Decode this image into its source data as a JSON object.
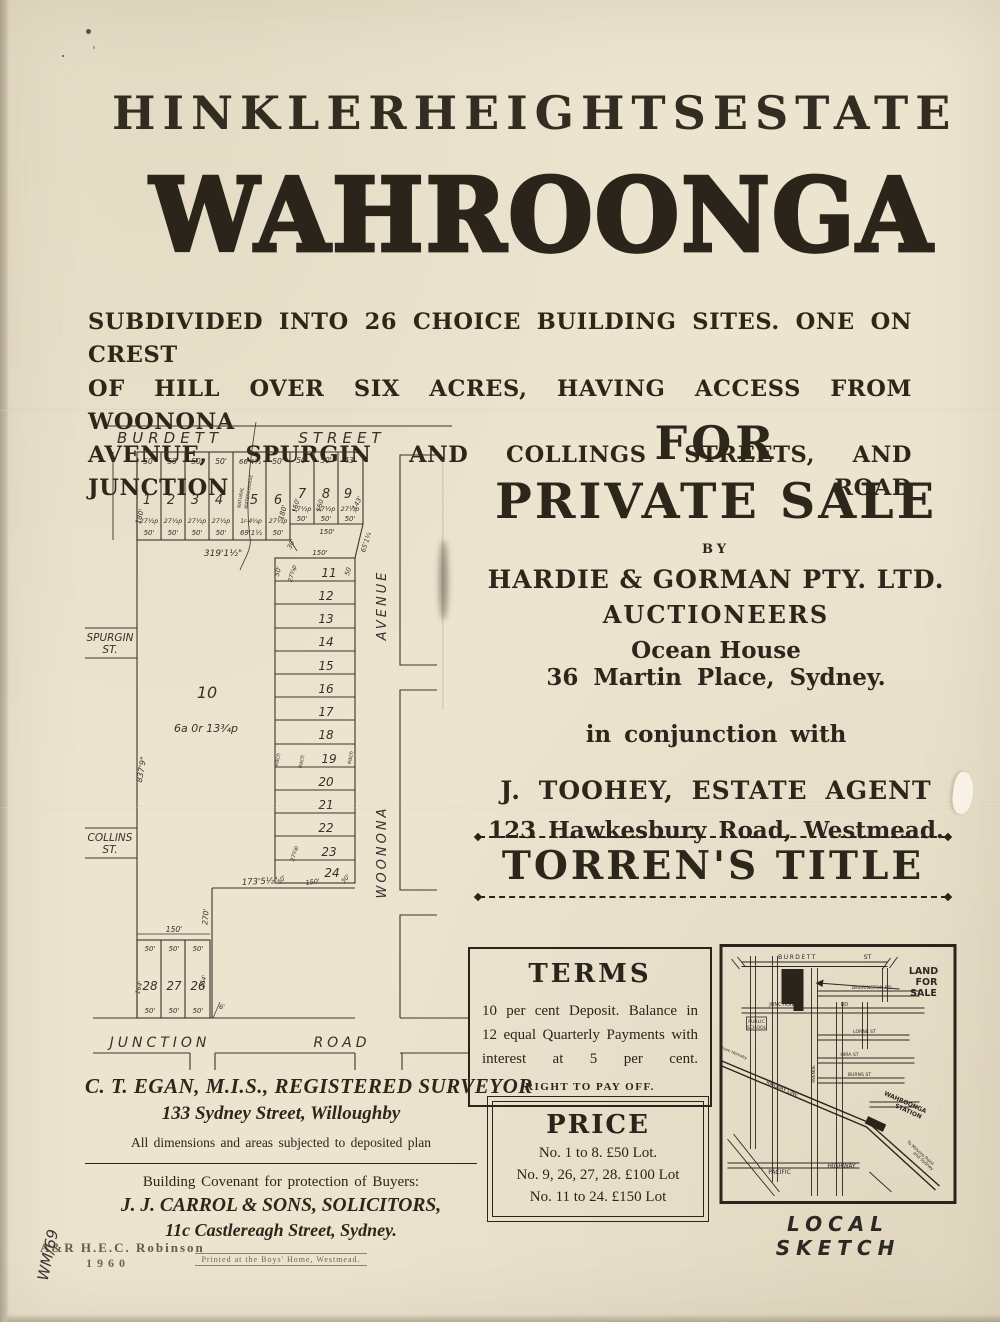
{
  "poster": {
    "kicker_words": [
      "HINKLER",
      "HEIGHTS",
      "ESTATE"
    ],
    "main_title": "WAHROONGA",
    "subtitle_lines": [
      "SUBDIVIDED INTO 26 CHOICE BUILDING SITES.  ONE ON CREST",
      "OF HILL OVER SIX ACRES, HAVING ACCESS FROM WOONONA",
      "AVENUE, SPURGIN AND COLLINGS STREETS, AND JUNCTION ROAD"
    ]
  },
  "sale": {
    "for": "FOR",
    "private_sale": "PRIVATE SALE",
    "by": "BY",
    "agent1": "HARDIE & GORMAN PTY. LTD.",
    "agent1_role": "AUCTIONEERS",
    "agent1_addr1": "Ocean House",
    "agent1_addr2": "36 Martin Place, Sydney.",
    "conjunction": "in conjunction with",
    "agent2": "J. TOOHEY, ESTATE AGENT",
    "agent2_addr": "123 Hawkesbury Road, Westmead."
  },
  "torrens_title": "TORREN'S TITLE",
  "terms": {
    "heading": "TERMS",
    "body": "10 per cent Deposit.  Balance in 12 equal Quarterly Payments with interest at 5 per cent.",
    "footnote": "RIGHT TO PAY OFF."
  },
  "price": {
    "heading": "PRICE",
    "lines": [
      "No. 1 to 8.   £50 Lot.",
      "No. 9, 26, 27, 28.  £100 Lot",
      "No. 11 to 24.  £150 Lot"
    ]
  },
  "surveyor": {
    "name": "C. T. EGAN, M.I.S., REGISTERED SURVEYOR",
    "address": "133 Sydney Street, Willoughby",
    "note": "All dimensions and areas subjected to deposited plan"
  },
  "covenant": {
    "intro": "Building Covenant for protection of Buyers:",
    "firm": "J. J. CARROL & SONS, SOLICITORS,",
    "firm_address": "11c Castlereagh Street, Sydney.",
    "printer": "Printed at the Boys' Home, Westmead."
  },
  "stamps": {
    "publisher": "A&R  H.E.C. Robinson",
    "year": "1960",
    "annotation": "WM/69"
  },
  "sketch": {
    "caption": "LOCAL SKETCH",
    "labels": [
      {
        "t": "BURDETT",
        "x": 78,
        "y": 15,
        "s": 6,
        "ls": 1.5
      },
      {
        "t": "ST",
        "x": 148,
        "y": 15,
        "s": 6
      },
      {
        "t": "LAND",
        "x": 204,
        "y": 30,
        "s": 9.5,
        "b": 1
      },
      {
        "t": "FOR",
        "x": 207,
        "y": 41,
        "s": 9.5,
        "b": 1
      },
      {
        "t": "SALE",
        "x": 204,
        "y": 52,
        "s": 9.5,
        "b": 1
      },
      {
        "t": "WARRINGTON RD",
        "x": 152,
        "y": 45,
        "s": 4.6
      },
      {
        "t": "JUNCTION",
        "x": 62,
        "y": 62,
        "s": 5
      },
      {
        "t": "RD",
        "x": 125,
        "y": 62,
        "s": 5
      },
      {
        "t": "PUBLIC",
        "x": 37,
        "y": 79,
        "s": 4.6
      },
      {
        "t": "SCHOOL",
        "x": 37,
        "y": 85,
        "s": 4.6
      },
      {
        "t": "LORNE ST",
        "x": 145,
        "y": 89,
        "s": 4.6
      },
      {
        "t": "HIRA ST",
        "x": 130,
        "y": 112,
        "s": 4.6
      },
      {
        "t": "BURNS ST",
        "x": 140,
        "y": 132,
        "s": 4.6
      },
      {
        "t": "AVENUE",
        "x": 95.5,
        "y": 130,
        "s": 4.4,
        "r": -90
      },
      {
        "t": "RAILWAY LINE",
        "x": 62,
        "y": 146,
        "s": 5,
        "r": 23
      },
      {
        "t": "WAHROONGA",
        "x": 185,
        "y": 160,
        "s": 6,
        "r": 24,
        "b": 1
      },
      {
        "t": "STATION",
        "x": 188,
        "y": 169,
        "s": 6,
        "r": 24,
        "b": 1
      },
      {
        "t": "To Milsons Point",
        "x": 200,
        "y": 210,
        "s": 4.4,
        "r": 42
      },
      {
        "t": "and Sydney",
        "x": 203,
        "y": 218,
        "s": 4.4,
        "r": 42
      },
      {
        "t": "From Hornsby",
        "x": 14,
        "y": 110,
        "s": 4,
        "r": 23
      },
      {
        "t": "PACIFIC",
        "x": 60,
        "y": 230,
        "s": 6
      },
      {
        "t": "HIGHWAY",
        "x": 122,
        "y": 224,
        "s": 6
      }
    ]
  },
  "plat": {
    "labels": [
      {
        "t": "BURDETT",
        "x": 90,
        "y": 23,
        "s": 15,
        "ls": 5
      },
      {
        "t": "STREET",
        "x": 262,
        "y": 23,
        "s": 15,
        "ls": 5
      },
      {
        "t": "SPURGIN",
        "x": 30,
        "y": 221,
        "s": 10.5
      },
      {
        "t": "ST.",
        "x": 30,
        "y": 233,
        "s": 10.5
      },
      {
        "t": "COLLINS",
        "x": 30,
        "y": 421,
        "s": 10.5
      },
      {
        "t": "ST.",
        "x": 30,
        "y": 433,
        "s": 10.5
      },
      {
        "t": "JUNCTION",
        "x": 80,
        "y": 627,
        "s": 14,
        "ls": 4
      },
      {
        "t": "ROAD",
        "x": 262,
        "y": 627,
        "s": 14,
        "ls": 4
      },
      {
        "t": "AVENUE",
        "x": 306,
        "y": 185,
        "s": 13,
        "r": -90,
        "ls": 3
      },
      {
        "t": "WOONONA",
        "x": 306,
        "y": 432,
        "s": 13,
        "r": -90,
        "ls": 3
      },
      {
        "t": "10",
        "x": 127,
        "y": 278,
        "s": 16
      },
      {
        "t": "6a 0r 13¾p",
        "x": 126,
        "y": 312,
        "s": 11
      },
      {
        "t": "837'9\"",
        "x": 64,
        "y": 350,
        "s": 8,
        "r": -80
      },
      {
        "t": "50'",
        "x": 69,
        "y": 44,
        "s": 7.5
      },
      {
        "t": "50'",
        "x": 93,
        "y": 44,
        "s": 7.5
      },
      {
        "t": "50'",
        "x": 117,
        "y": 44,
        "s": 7.5
      },
      {
        "t": "50'",
        "x": 141,
        "y": 44,
        "s": 7.5
      },
      {
        "t": "66'4½",
        "x": 170,
        "y": 44,
        "s": 7
      },
      {
        "t": "50'",
        "x": 198,
        "y": 44,
        "s": 7.5
      },
      {
        "t": "50'",
        "x": 222,
        "y": 43,
        "s": 7.5
      },
      {
        "t": "50'",
        "x": 246,
        "y": 43,
        "s": 7.5
      },
      {
        "t": "43'",
        "x": 270,
        "y": 43,
        "s": 7.5
      },
      {
        "t": "1",
        "x": 67,
        "y": 84,
        "s": 13
      },
      {
        "t": "2",
        "x": 91,
        "y": 84,
        "s": 13
      },
      {
        "t": "3",
        "x": 115,
        "y": 84,
        "s": 13
      },
      {
        "t": "4",
        "x": 139,
        "y": 84,
        "s": 13
      },
      {
        "t": "5",
        "x": 174,
        "y": 84,
        "s": 13
      },
      {
        "t": "6",
        "x": 198,
        "y": 84,
        "s": 13
      },
      {
        "t": "7",
        "x": 222,
        "y": 78,
        "s": 13
      },
      {
        "t": "8",
        "x": 246,
        "y": 78,
        "s": 13
      },
      {
        "t": "9",
        "x": 268,
        "y": 78,
        "s": 13
      },
      {
        "t": "180'",
        "x": 62,
        "y": 97,
        "s": 7,
        "r": -75
      },
      {
        "t": "180'",
        "x": 205,
        "y": 93,
        "s": 7,
        "r": -75
      },
      {
        "t": "150'",
        "x": 218,
        "y": 86,
        "s": 6.5,
        "r": -75
      },
      {
        "t": "150",
        "x": 242,
        "y": 86,
        "s": 6.5,
        "r": -75
      },
      {
        "t": "143'",
        "x": 279,
        "y": 84,
        "s": 6.5,
        "r": -62
      },
      {
        "t": "27½p",
        "x": 69,
        "y": 103,
        "s": 6.5
      },
      {
        "t": "27½p",
        "x": 93,
        "y": 103,
        "s": 6.5
      },
      {
        "t": "27½p",
        "x": 117,
        "y": 103,
        "s": 6.5
      },
      {
        "t": "27½p",
        "x": 141,
        "y": 103,
        "s": 6.5
      },
      {
        "t": "1r-4¾p",
        "x": 171,
        "y": 103,
        "s": 6
      },
      {
        "t": "27½p",
        "x": 198,
        "y": 103,
        "s": 6.5
      },
      {
        "t": "27½p",
        "x": 222,
        "y": 91,
        "s": 6.5
      },
      {
        "t": "27½p",
        "x": 246,
        "y": 91,
        "s": 6.5
      },
      {
        "t": "27½p",
        "x": 270,
        "y": 91,
        "s": 6.5
      },
      {
        "t": "50'",
        "x": 69,
        "y": 115,
        "s": 7
      },
      {
        "t": "50'",
        "x": 93,
        "y": 115,
        "s": 7
      },
      {
        "t": "50'",
        "x": 117,
        "y": 115,
        "s": 7
      },
      {
        "t": "50'",
        "x": 141,
        "y": 115,
        "s": 7
      },
      {
        "t": "69'1½",
        "x": 171,
        "y": 115,
        "s": 7
      },
      {
        "t": "50'",
        "x": 198,
        "y": 115,
        "s": 7
      },
      {
        "t": "50'",
        "x": 222,
        "y": 101,
        "s": 7
      },
      {
        "t": "50'",
        "x": 246,
        "y": 101,
        "s": 7
      },
      {
        "t": "50'",
        "x": 270,
        "y": 101,
        "s": 7
      },
      {
        "t": "30'",
        "x": 213,
        "y": 125,
        "s": 6.5,
        "r": -65
      },
      {
        "t": "150'",
        "x": 247,
        "y": 114,
        "s": 7
      },
      {
        "t": "65'1¼",
        "x": 288,
        "y": 123,
        "s": 6.5,
        "r": -72
      },
      {
        "t": "319'1½\"",
        "x": 143,
        "y": 136,
        "s": 9
      },
      {
        "t": "NATURAL",
        "x": 162,
        "y": 78,
        "s": 4.5,
        "r": -81
      },
      {
        "t": "WATERCOURSE",
        "x": 170,
        "y": 72,
        "s": 4.5,
        "r": -81
      },
      {
        "t": "150'",
        "x": 240,
        "y": 135,
        "s": 7
      },
      {
        "t": "50'",
        "x": 200,
        "y": 152,
        "s": 6.5,
        "r": -75
      },
      {
        "t": "27¾p",
        "x": 214,
        "y": 154,
        "s": 6,
        "r": -75
      },
      {
        "t": "50",
        "x": 270,
        "y": 152,
        "s": 6.5,
        "r": -75
      },
      {
        "t": "11",
        "x": 249,
        "y": 157,
        "s": 12
      },
      {
        "t": "12",
        "x": 246,
        "y": 180,
        "s": 12
      },
      {
        "t": "13",
        "x": 246,
        "y": 203,
        "s": 12
      },
      {
        "t": "14",
        "x": 246,
        "y": 226,
        "s": 12
      },
      {
        "t": "15",
        "x": 246,
        "y": 250,
        "s": 12
      },
      {
        "t": "16",
        "x": 246,
        "y": 273,
        "s": 12
      },
      {
        "t": "17",
        "x": 246,
        "y": 296,
        "s": 12
      },
      {
        "t": "18",
        "x": 246,
        "y": 319,
        "s": 12
      },
      {
        "t": "19",
        "x": 249,
        "y": 343,
        "s": 12
      },
      {
        "t": "20",
        "x": 246,
        "y": 366,
        "s": 12
      },
      {
        "t": "21",
        "x": 246,
        "y": 389,
        "s": 12
      },
      {
        "t": "22",
        "x": 246,
        "y": 412,
        "s": 12
      },
      {
        "t": "23",
        "x": 249,
        "y": 436,
        "s": 12
      },
      {
        "t": "24",
        "x": 252,
        "y": 457,
        "s": 12
      },
      {
        "t": "each",
        "x": 199,
        "y": 340,
        "s": 5.5,
        "r": -75
      },
      {
        "t": "each",
        "x": 223,
        "y": 342,
        "s": 5.5,
        "r": -75
      },
      {
        "t": "each",
        "x": 272,
        "y": 338,
        "s": 5.5,
        "r": -75
      },
      {
        "t": "27¾p",
        "x": 216,
        "y": 434,
        "s": 5.5,
        "r": -75
      },
      {
        "t": "50'",
        "x": 203,
        "y": 461,
        "s": 6,
        "r": -45
      },
      {
        "t": "150'",
        "x": 233,
        "y": 464,
        "s": 6.5,
        "r": -8
      },
      {
        "t": "50'",
        "x": 267,
        "y": 460,
        "s": 6,
        "r": -45
      },
      {
        "t": "173'5½\"",
        "x": 180,
        "y": 464,
        "s": 8.5,
        "r": -3
      },
      {
        "t": "270'",
        "x": 128,
        "y": 497,
        "s": 7.5,
        "r": -85
      },
      {
        "t": "150'",
        "x": 94,
        "y": 512,
        "s": 7.5
      },
      {
        "t": "50'",
        "x": 70,
        "y": 531,
        "s": 7
      },
      {
        "t": "50'",
        "x": 94,
        "y": 531,
        "s": 7
      },
      {
        "t": "50'",
        "x": 118,
        "y": 531,
        "s": 7
      },
      {
        "t": "28",
        "x": 70,
        "y": 570,
        "s": 12
      },
      {
        "t": "27",
        "x": 94,
        "y": 570,
        "s": 12
      },
      {
        "t": "26",
        "x": 118,
        "y": 570,
        "s": 12
      },
      {
        "t": "164'",
        "x": 61,
        "y": 568,
        "s": 6,
        "r": -75
      },
      {
        "t": "164'",
        "x": 125,
        "y": 562,
        "s": 6,
        "r": -75
      },
      {
        "t": "50'",
        "x": 70,
        "y": 593,
        "s": 7
      },
      {
        "t": "50'",
        "x": 94,
        "y": 593,
        "s": 7
      },
      {
        "t": "50'",
        "x": 118,
        "y": 593,
        "s": 7
      },
      {
        "t": "6'",
        "x": 142,
        "y": 589,
        "s": 6.5
      }
    ]
  }
}
